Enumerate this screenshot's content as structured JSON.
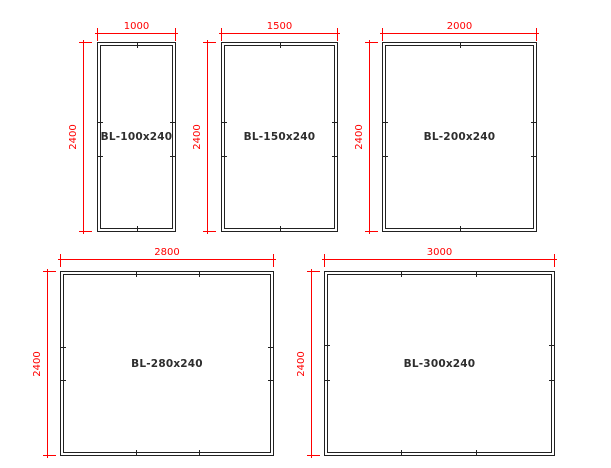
{
  "diagram": {
    "type": "panel-elevation-drawing",
    "colors": {
      "dimension": "#ff0000",
      "outline": "#212121",
      "label": "#2e2e2e",
      "background": "#ffffff"
    },
    "panels": [
      {
        "name": "BL-100x240",
        "width_mm": "1000",
        "height_mm": "2400"
      },
      {
        "name": "BL-150x240",
        "width_mm": "1500",
        "height_mm": "2400"
      },
      {
        "name": "BL-200x240",
        "width_mm": "2000",
        "height_mm": "2400"
      },
      {
        "name": "BL-280x240",
        "width_mm": "2800",
        "height_mm": "2400"
      },
      {
        "name": "BL-300x240",
        "width_mm": "3000",
        "height_mm": "2400"
      }
    ]
  }
}
